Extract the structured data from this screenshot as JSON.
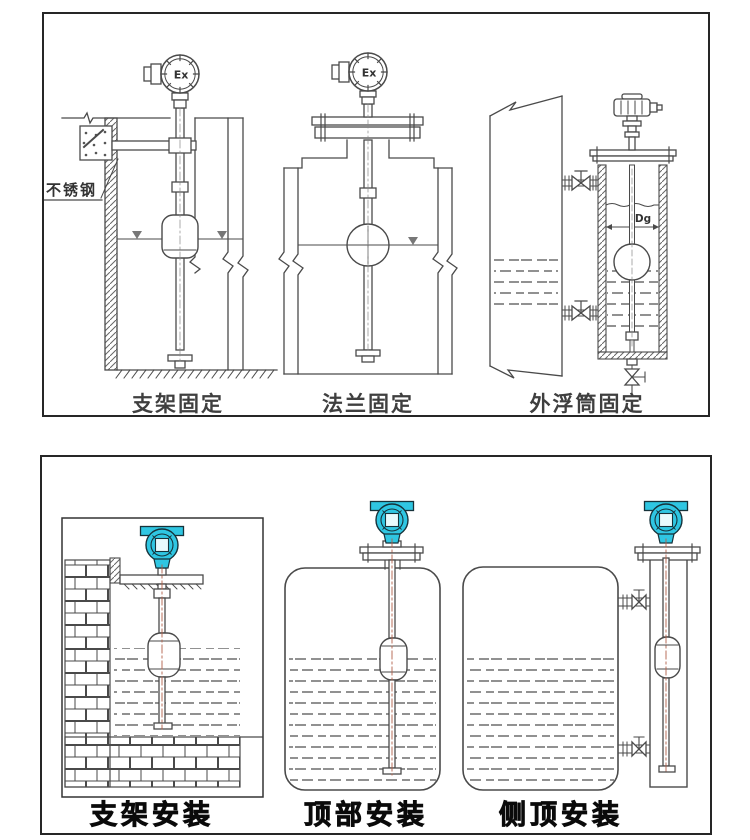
{
  "page": {
    "background": "#ffffff"
  },
  "colors": {
    "line": "#4a4a4a",
    "panel_border": "#262626",
    "caption_top": "#3f3f3f",
    "caption_bottom": "#0a0a0a",
    "transmitter_teal": "#2fc6e2",
    "transmitter_screen": "#e8fafd",
    "centerline_red": "#b2604a"
  },
  "top_panel": {
    "captions": {
      "bracket": "支架固定",
      "flange": "法兰固定",
      "external_chamber": "外浮筒固定"
    },
    "labels": {
      "ex": "Ex",
      "stainless_steel": "不锈钢",
      "diameter": "Dg"
    }
  },
  "bottom_panel": {
    "captions": {
      "bracket": "支架安装",
      "top_mount": "顶部安装",
      "side_top_mount": "侧顶安装"
    }
  }
}
